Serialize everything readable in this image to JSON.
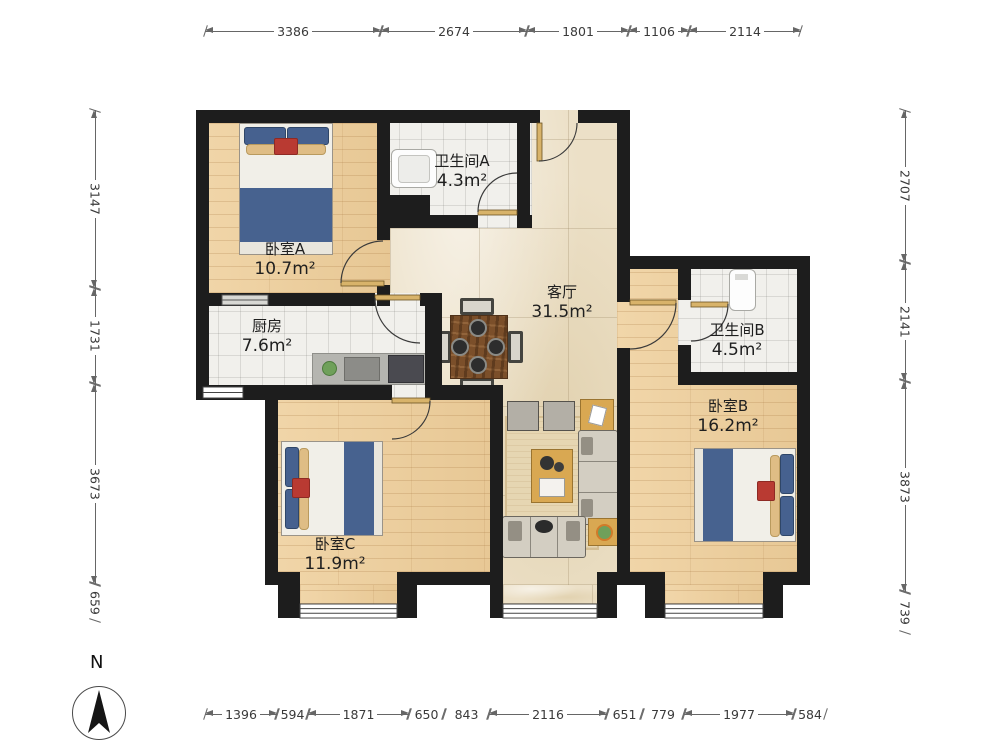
{
  "rooms": [
    {
      "id": "bedroom-a",
      "name": "卧室A",
      "area": "10.7m²"
    },
    {
      "id": "bathroom-a",
      "name": "卫生间A",
      "area": "4.3m²"
    },
    {
      "id": "living-room",
      "name": "客厅",
      "area": "31.5m²"
    },
    {
      "id": "kitchen",
      "name": "厨房",
      "area": "7.6m²"
    },
    {
      "id": "bathroom-b",
      "name": "卫生间B",
      "area": "4.5m²"
    },
    {
      "id": "bedroom-b",
      "name": "卧室B",
      "area": "16.2m²"
    },
    {
      "id": "bedroom-c",
      "name": "卧室C",
      "area": "11.9m²"
    }
  ],
  "dimensions": {
    "top": [
      "3386",
      "2674",
      "1801",
      "1106",
      "2114"
    ],
    "left": [
      "3147",
      "1731",
      "3673",
      "659"
    ],
    "right": [
      "2707",
      "2141",
      "3873",
      "739"
    ],
    "bottom": [
      "1396",
      "594",
      "1871",
      "650",
      "843",
      "2116",
      "651",
      "779",
      "1977",
      "584"
    ]
  },
  "compass": {
    "label": "N"
  },
  "colors": {
    "wall": "#1d1d1d",
    "wood_floor": "#ebcd9c",
    "tile_floor": "#f1f0ec",
    "marble_floor": "#ece0c7",
    "bed_blanket": "#47628f",
    "accent_table": "#d9a852",
    "dimension_text": "#3a3a3a"
  }
}
